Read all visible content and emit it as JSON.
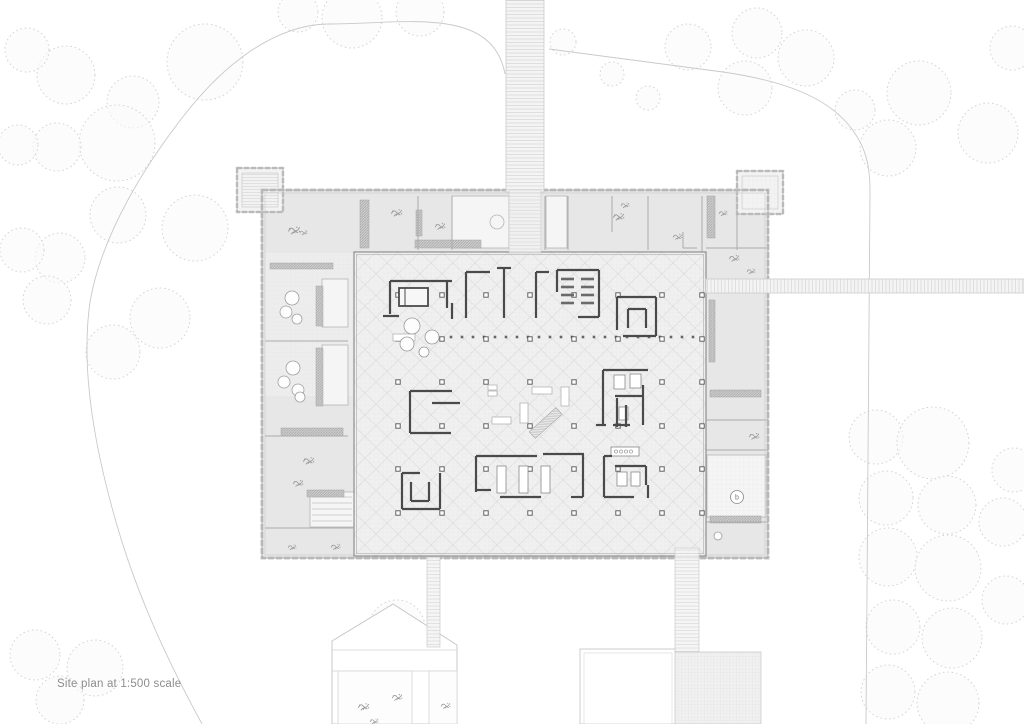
{
  "caption": "Site plan at 1:500 scale",
  "room_marker": "b",
  "colors": {
    "band_fill": "#e7e7e7",
    "hall_fill": "#f0f0f0",
    "wall_dark": "#4a4a4a",
    "outline_gray": "#a3a3a3",
    "castellation": "#cacaca",
    "tree_stroke": "#d4d4d4",
    "boundary": "#c9c9c9",
    "planter": "#bdbdbd",
    "plant": "#9b9b9b"
  },
  "drawing": {
    "trees": [
      [
        205,
        62,
        38
      ],
      [
        133,
        102,
        26
      ],
      [
        66,
        75,
        29
      ],
      [
        27,
        50,
        22
      ],
      [
        117,
        143,
        38
      ],
      [
        57,
        147,
        24
      ],
      [
        18,
        145,
        20
      ],
      [
        195,
        228,
        33
      ],
      [
        118,
        215,
        28
      ],
      [
        60,
        258,
        25
      ],
      [
        22,
        250,
        22
      ],
      [
        160,
        318,
        30
      ],
      [
        113,
        352,
        27
      ],
      [
        47,
        300,
        24
      ],
      [
        352,
        18,
        30
      ],
      [
        420,
        12,
        24
      ],
      [
        298,
        12,
        20
      ],
      [
        563,
        42,
        13
      ],
      [
        612,
        74,
        12
      ],
      [
        648,
        98,
        12
      ],
      [
        757,
        33,
        25
      ],
      [
        806,
        58,
        28
      ],
      [
        745,
        88,
        27
      ],
      [
        688,
        47,
        23
      ],
      [
        919,
        93,
        32
      ],
      [
        988,
        133,
        30
      ],
      [
        888,
        148,
        28
      ],
      [
        1012,
        48,
        22
      ],
      [
        855,
        110,
        20
      ],
      [
        876,
        437,
        27
      ],
      [
        933,
        443,
        36
      ],
      [
        886,
        498,
        27
      ],
      [
        947,
        505,
        29
      ],
      [
        888,
        557,
        29
      ],
      [
        948,
        568,
        33
      ],
      [
        893,
        627,
        27
      ],
      [
        952,
        638,
        30
      ],
      [
        888,
        692,
        27
      ],
      [
        948,
        703,
        31
      ],
      [
        1003,
        522,
        24
      ],
      [
        1006,
        600,
        24
      ],
      [
        1014,
        470,
        22
      ],
      [
        35,
        655,
        25
      ],
      [
        95,
        668,
        28
      ],
      [
        60,
        700,
        24
      ],
      [
        397,
        628,
        28
      ]
    ],
    "boundary": [
      "M505,74 C500,47 483,31 452,25 C418,18 372,24 328,24 C276,25 225,62 182,118 C148,162 102,232 90,302 C80,372 96,452 116,522 C136,592 166,658 202,724",
      "M549,49 L723,72 C792,82 833,101 854,132 C866,149 870,166 870,192 L866,724"
    ],
    "site_paths": [
      {
        "x": 506,
        "y": 0,
        "w": 38,
        "h": 192,
        "p": "ladderH",
        "o": 1
      },
      {
        "x": 509,
        "y": 190,
        "w": 32,
        "h": 64,
        "p": "ladderH",
        "o": 0.7
      },
      {
        "x": 706,
        "y": 279,
        "w": 318,
        "h": 14,
        "p": "ladderV",
        "o": 1
      },
      {
        "x": 427,
        "y": 557,
        "w": 13,
        "h": 90,
        "p": "ladderH",
        "o": 0.9
      },
      {
        "x": 675,
        "y": 548,
        "w": 24,
        "h": 104,
        "p": "ladderH",
        "o": 0.9
      },
      {
        "x": 675,
        "y": 652,
        "w": 86,
        "h": 72,
        "p": "plaza",
        "o": 1
      }
    ],
    "pentagon": {
      "pts": "332,641 393,604 457,645 457,724 332,724",
      "lines": [
        [
          332,
          650,
          457,
          650
        ],
        [
          332,
          671,
          457,
          671
        ]
      ],
      "rects": [
        [
          338,
          671,
          74,
          53
        ],
        [
          429,
          671,
          28,
          53
        ]
      ],
      "plants": [
        [
          357,
          700,
          1.3
        ],
        [
          391,
          691,
          1.2
        ],
        [
          440,
          700,
          1.1
        ],
        [
          369,
          716,
          1.0
        ]
      ]
    },
    "se_rect": [
      580,
      649,
      96,
      75
    ],
    "building": {
      "outer": [
        262,
        190,
        506,
        368
      ],
      "hall": [
        354,
        252,
        352,
        304
      ],
      "pavilions": [
        {
          "r": [
            237,
            168,
            46,
            44
          ],
          "deck": "deckH"
        },
        {
          "r": [
            737,
            171,
            46,
            43
          ],
          "deck": "fine"
        }
      ],
      "white_rooms": [
        [
          452,
          196,
          57,
          52
        ],
        [
          546,
          196,
          21,
          52
        ],
        [
          322,
          279,
          26,
          48
        ],
        [
          322,
          345,
          26,
          60
        ],
        [
          310,
          492,
          44,
          35
        ],
        [
          707,
          455,
          59,
          62
        ]
      ],
      "room_bump": [
        497,
        222,
        7
      ],
      "stair_room": {
        "x": 312,
        "y": 497,
        "x2": 352,
        "ys": [
          497,
          503,
          509,
          515,
          521
        ]
      },
      "terrace": [
        265,
        253,
        89,
        143
      ],
      "planters": [
        [
          360,
          200,
          9,
          48
        ],
        [
          416,
          210,
          6,
          26
        ],
        [
          415,
          240,
          66,
          8
        ],
        [
          270,
          263,
          63,
          6
        ],
        [
          316,
          286,
          7,
          40
        ],
        [
          316,
          348,
          7,
          58
        ],
        [
          281,
          428,
          62,
          8
        ],
        [
          307,
          490,
          37,
          7
        ],
        [
          707,
          196,
          8,
          42
        ],
        [
          709,
          300,
          6,
          62
        ],
        [
          710,
          390,
          51,
          7
        ],
        [
          710,
          516,
          51,
          7
        ],
        [
          361,
          290,
          4,
          28
        ]
      ],
      "partitions": [
        [
          418,
          196,
          418,
          250
        ],
        [
          452,
          196,
          452,
          250
        ],
        [
          545,
          196,
          545,
          250
        ],
        [
          568,
          196,
          568,
          250
        ],
        [
          612,
          196,
          612,
          232
        ],
        [
          648,
          196,
          648,
          250
        ],
        [
          702,
          196,
          702,
          272
        ],
        [
          737,
          196,
          737,
          250
        ],
        [
          265,
          341,
          348,
          341
        ],
        [
          265,
          436,
          348,
          436
        ],
        [
          265,
          528,
          353,
          528
        ],
        [
          706,
          248,
          768,
          248
        ],
        [
          706,
          420,
          768,
          420
        ],
        [
          706,
          450,
          768,
          450
        ],
        [
          706,
          522,
          768,
          522
        ],
        [
          683,
          232,
          683,
          248
        ],
        [
          683,
          248,
          697,
          248
        ]
      ],
      "tables": [
        [
          292,
          298,
          7
        ],
        [
          286,
          312,
          6
        ],
        [
          297,
          319,
          5
        ],
        [
          293,
          368,
          7
        ],
        [
          284,
          382,
          6
        ],
        [
          298,
          390,
          6
        ],
        [
          300,
          397,
          5
        ],
        [
          718,
          536,
          4
        ]
      ],
      "plants": [
        [
          287,
          223,
          1.4
        ],
        [
          299,
          228,
          0.9
        ],
        [
          390,
          206,
          1.3
        ],
        [
          434,
          220,
          1.2
        ],
        [
          612,
          210,
          1.3
        ],
        [
          672,
          231,
          1.1
        ],
        [
          728,
          252,
          1.2
        ],
        [
          746,
          266,
          1.0
        ],
        [
          718,
          208,
          1.0
        ],
        [
          620,
          200,
          1.0
        ],
        [
          302,
          454,
          1.3
        ],
        [
          292,
          477,
          1.2
        ],
        [
          330,
          541,
          1.1
        ],
        [
          287,
          542,
          1.0
        ],
        [
          748,
          430,
          1.2
        ]
      ],
      "columns": {
        "xs": [
          398,
          442,
          486,
          530,
          574,
          618,
          662,
          702
        ],
        "ys": [
          295,
          339,
          382,
          426,
          469,
          513
        ]
      },
      "stands": {
        "y": 337,
        "x0": 451,
        "x1": 700,
        "step": 11
      },
      "walls": [
        [
          390,
          281,
          452,
          281
        ],
        [
          390,
          281,
          390,
          314
        ],
        [
          447,
          281,
          447,
          308
        ],
        [
          383,
          316,
          399,
          316
        ],
        [
          452,
          303,
          452,
          319
        ],
        [
          466,
          272,
          466,
          318
        ],
        [
          466,
          272,
          490,
          272
        ],
        [
          504,
          268,
          504,
          318
        ],
        [
          497,
          268,
          511,
          268
        ],
        [
          536,
          272,
          536,
          318
        ],
        [
          536,
          272,
          549,
          272
        ],
        [
          557,
          270,
          599,
          270
        ],
        [
          599,
          270,
          599,
          317
        ],
        [
          578,
          317,
          599,
          317
        ],
        [
          557,
          270,
          557,
          292
        ],
        [
          617,
          297,
          656,
          297
        ],
        [
          656,
          297,
          656,
          336
        ],
        [
          623,
          336,
          656,
          336
        ],
        [
          617,
          297,
          617,
          330
        ],
        [
          628,
          309,
          646,
          309
        ],
        [
          628,
          309,
          628,
          328
        ],
        [
          646,
          309,
          646,
          328
        ],
        [
          410,
          391,
          452,
          391
        ],
        [
          410,
          391,
          410,
          433
        ],
        [
          410,
          433,
          451,
          433
        ],
        [
          432,
          403,
          460,
          403
        ],
        [
          402,
          473,
          402,
          509
        ],
        [
          402,
          509,
          440,
          509
        ],
        [
          440,
          473,
          440,
          509
        ],
        [
          402,
          473,
          420,
          473
        ],
        [
          411,
          482,
          411,
          501
        ],
        [
          411,
          501,
          429,
          501
        ],
        [
          429,
          482,
          429,
          501
        ],
        [
          476,
          456,
          537,
          456
        ],
        [
          543,
          454,
          584,
          454
        ],
        [
          476,
          456,
          476,
          492
        ],
        [
          476,
          490,
          491,
          490
        ],
        [
          500,
          497,
          541,
          497
        ],
        [
          583,
          454,
          583,
          497
        ],
        [
          571,
          497,
          583,
          497
        ],
        [
          603,
          370,
          648,
          370
        ],
        [
          603,
          370,
          603,
          425
        ],
        [
          643,
          385,
          643,
          425
        ],
        [
          615,
          396,
          643,
          396
        ],
        [
          617,
          398,
          617,
          427
        ],
        [
          626,
          405,
          626,
          427
        ],
        [
          613,
          425,
          630,
          425
        ],
        [
          596,
          425,
          606,
          425
        ],
        [
          604,
          456,
          604,
          497
        ],
        [
          604,
          456,
          612,
          456
        ],
        [
          604,
          497,
          634,
          497
        ],
        [
          615,
          466,
          646,
          466
        ],
        [
          646,
          466,
          646,
          485
        ],
        [
          648,
          485,
          648,
          498
        ]
      ],
      "shelves": {
        "rows": [
          279,
          287,
          295,
          303
        ],
        "cols": [
          [
            561,
            574
          ],
          [
            581,
            594
          ]
        ]
      },
      "bench_rect": [
        399,
        288,
        29,
        18
      ],
      "beds": [
        [
          614,
          375,
          11,
          14
        ],
        [
          630,
          374,
          11,
          14
        ],
        [
          619,
          407,
          9,
          13
        ],
        [
          617,
          472,
          10,
          14
        ],
        [
          631,
          472,
          9,
          14
        ],
        [
          497,
          466,
          9,
          27
        ],
        [
          519,
          466,
          9,
          27
        ],
        [
          541,
          466,
          9,
          27
        ]
      ],
      "furniture": [
        [
          532,
          387,
          20,
          7
        ],
        [
          561,
          387,
          8,
          19
        ],
        [
          520,
          403,
          8,
          20
        ],
        [
          492,
          417,
          19,
          7
        ],
        [
          488,
          385,
          9,
          5
        ],
        [
          488,
          391,
          9,
          5
        ],
        [
          393,
          334,
          22,
          7
        ]
      ],
      "vitrine": {
        "r": [
          611,
          447,
          28,
          9
        ],
        "cx": [
          616,
          621,
          626,
          631
        ],
        "cy": 451.5
      },
      "hall_tables": [
        [
          412,
          326,
          8
        ],
        [
          432,
          337,
          7
        ],
        [
          407,
          344,
          7
        ],
        [
          424,
          352,
          5
        ]
      ],
      "ramp": {
        "r": [
          542,
          405,
          9,
          36
        ],
        "rot": [
          48,
          546,
          422
        ]
      },
      "marker": {
        "x": 737,
        "y": 497,
        "r": 6.5
      }
    }
  }
}
